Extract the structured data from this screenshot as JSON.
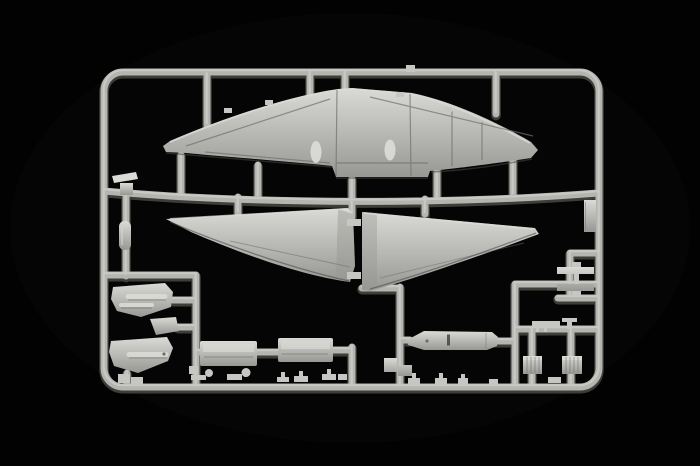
{
  "scene": {
    "subject": "plastic model kit sprue photographed on a black background",
    "background_color": "#020202",
    "vignette_color": "#181818"
  },
  "colors": {
    "plastic_light": "#dadad6",
    "plastic_mid": "#c6c6c2",
    "plastic_base": "#b4b4b0",
    "plastic_dim": "#979793",
    "line_dark": "#6f6f6b",
    "edge_shadow": "#45453f"
  },
  "parts": {
    "frame": "Sprue frame and runners",
    "upper_wing": "Full-span upper wing",
    "left_lower_wing": "Left lower wing panel",
    "right_lower_wing": "Right lower wing panel",
    "door_upper": "Curved door panel (upper)",
    "door_link": "Small bracket part",
    "door_lower": "Curved door panel (lower)",
    "flap_left": "Rectangular flap part (left)",
    "flap_right": "Rectangular flap part (right)",
    "belly_panel": "Long belly panel",
    "square_parts": "Small square parts",
    "rail_fitting": "Rail-mounted strip part",
    "hatch_bars": "Paired hatch strip parts",
    "box_left": "Ribbed box part (left)",
    "box_right": "Ribbed box part (right)",
    "runner_fittings": "Small fittings on lower runner",
    "left_small_parts": "Small parts on left runner",
    "root_links": "Wing-root link stubs",
    "nacelle_left": "Engine nacelle fairing (left)",
    "nacelle_right": "Engine nacelle fairing (right)",
    "bottom_small_parts": "Assorted small parts on bottom rail",
    "rail_nub": "Runner junction nub"
  }
}
